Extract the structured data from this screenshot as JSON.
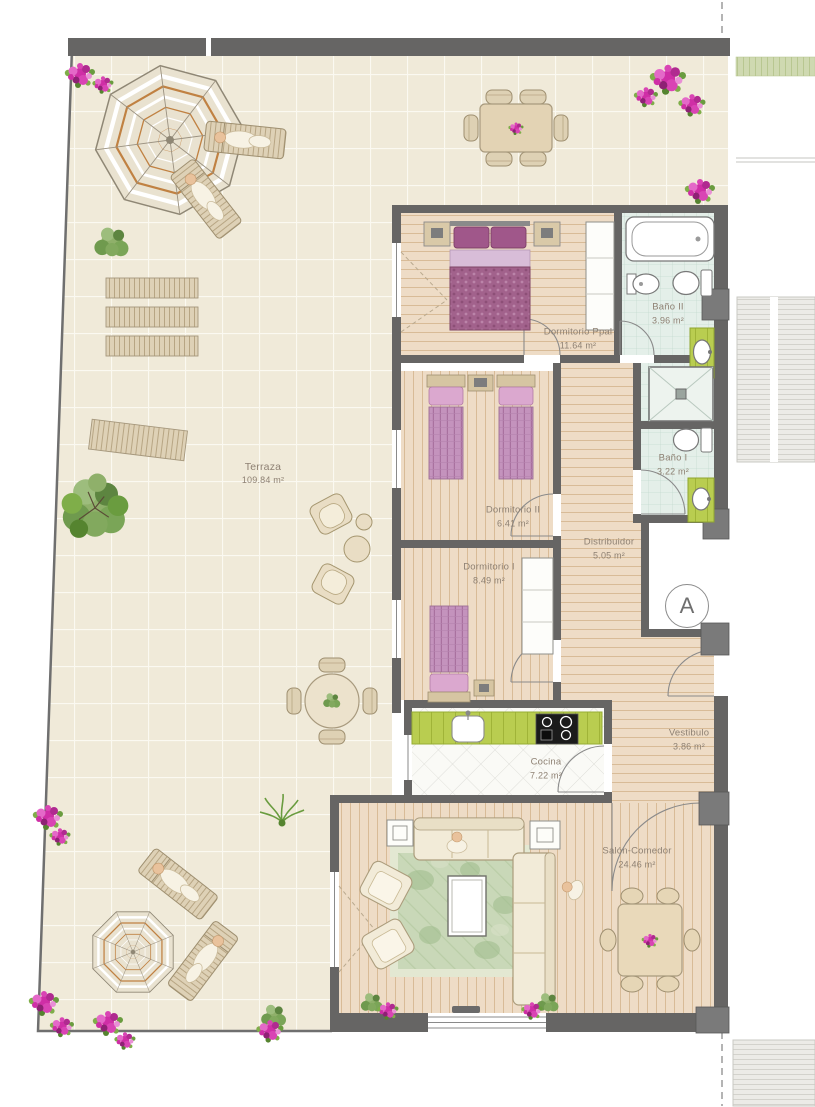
{
  "plan": {
    "marker": {
      "label": "A"
    },
    "rooms": [
      {
        "name": "Terraza",
        "area": "109.84 m²"
      },
      {
        "name": "Dormitorio Ppal",
        "area": "11.64 m²"
      },
      {
        "name": "Baño II",
        "area": "3.96 m²"
      },
      {
        "name": "Baño I",
        "area": "3.22 m²"
      },
      {
        "name": "Dormitorio II",
        "area": "6.41 m²"
      },
      {
        "name": "Distribuidor",
        "area": "5.05 m²"
      },
      {
        "name": "Dormitorio I",
        "area": "8.49 m²"
      },
      {
        "name": "Vestibulo",
        "area": "3.86 m²"
      },
      {
        "name": "Cocina",
        "area": "7.22 m²"
      },
      {
        "name": "Salón-Comedor",
        "area": "24.46 m²"
      }
    ],
    "colors": {
      "wall": "#666564",
      "terrace_tile": "#f0ead9",
      "wood_floor": "#eedcc6",
      "bath_tile": "#e4efe9",
      "kitchen_counter": "#b9cd50",
      "bed_duvet": "#a2628c",
      "rug_green": "#c9d8b8",
      "flower_magenta": "#cf2ea6",
      "label_text": "#8e8173"
    }
  }
}
